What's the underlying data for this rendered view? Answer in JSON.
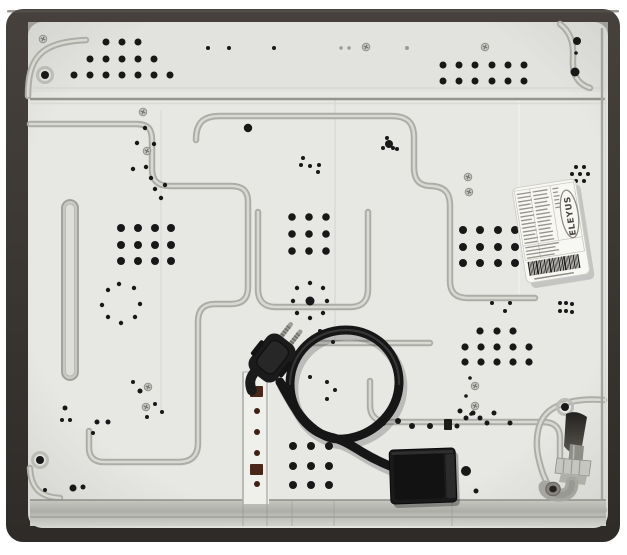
{
  "photo": {
    "subject": "Underside back panel of a built-in gas hob",
    "brand": "ELEYUS"
  },
  "label": {
    "brand": "ELEYUS",
    "bars": [
      [
        -28,
        -42,
        14
      ],
      [
        -12,
        -42,
        15
      ],
      [
        8,
        -42,
        6
      ],
      [
        -28,
        -38.2,
        13
      ],
      [
        -12,
        -38.2,
        14
      ],
      [
        8,
        -38.2,
        5
      ],
      [
        -28,
        -34.4,
        14
      ],
      [
        -12,
        -34.4,
        15
      ],
      [
        8,
        -34.4,
        6
      ],
      [
        -28,
        -30.6,
        12
      ],
      [
        -12,
        -30.6,
        13
      ],
      [
        8,
        -30.6,
        5
      ],
      [
        -28,
        -26.8,
        14
      ],
      [
        -12,
        -26.8,
        15
      ],
      [
        8,
        -26.8,
        6
      ],
      [
        -28,
        -23,
        13
      ],
      [
        -12,
        -23,
        12
      ],
      [
        8,
        -23,
        5
      ],
      [
        -28,
        -19.2,
        14
      ],
      [
        -12,
        -19.2,
        14
      ],
      [
        -28,
        -15.4,
        11
      ],
      [
        -12,
        -15.4,
        15
      ],
      [
        -28,
        -11.6,
        14
      ],
      [
        -12,
        -11.6,
        13
      ],
      [
        -28,
        -7.8,
        13
      ],
      [
        -12,
        -7.8,
        14
      ],
      [
        -28,
        -4,
        14
      ],
      [
        -12,
        -4,
        12
      ],
      [
        -28,
        -0.2,
        12
      ],
      [
        -12,
        -0.2,
        14
      ],
      [
        -28,
        3.6,
        14
      ],
      [
        -12,
        3.6,
        13
      ],
      [
        -28,
        7.4,
        13
      ],
      [
        -12,
        7.4,
        14
      ],
      [
        -28,
        12,
        34
      ],
      [
        -28,
        15.5,
        30
      ],
      [
        -28,
        19,
        33
      ],
      [
        -28,
        22.5,
        28
      ]
    ],
    "barcode": [
      2,
      1,
      1,
      2,
      1,
      3,
      1,
      2,
      1,
      1,
      2,
      1,
      1,
      3,
      1,
      2,
      1,
      1,
      1,
      2,
      1,
      2,
      3,
      1,
      1,
      2,
      1,
      1,
      2,
      1,
      1,
      2
    ]
  },
  "scene": {
    "colors": {
      "hole": "#181818",
      "dimple": "#9a9a96",
      "bracket_hole": "#3c2114"
    },
    "hole_groups": [
      {
        "name": "vents-top-left-pyramid",
        "r": 3.5,
        "points": [
          [
            106,
            42
          ],
          [
            122,
            42
          ],
          [
            138,
            42
          ],
          [
            90,
            59
          ],
          [
            106,
            59
          ],
          [
            122,
            59
          ],
          [
            138,
            59
          ],
          [
            154,
            59
          ],
          [
            74,
            75
          ],
          [
            90,
            75
          ],
          [
            106,
            75
          ],
          [
            122,
            75
          ],
          [
            138,
            75
          ],
          [
            154,
            75
          ],
          [
            170,
            75
          ]
        ]
      },
      {
        "name": "vents-top-small-trio",
        "r": 2,
        "points": [
          [
            208,
            48
          ],
          [
            229,
            48
          ],
          [
            274,
            48
          ]
        ]
      },
      {
        "name": "vents-top-right-grid",
        "r": 3.5,
        "points": [
          [
            443,
            65
          ],
          [
            459,
            65
          ],
          [
            475,
            65
          ],
          [
            492,
            65
          ],
          [
            508,
            65
          ],
          [
            524,
            65
          ],
          [
            443,
            81
          ],
          [
            459,
            81
          ],
          [
            475,
            81
          ],
          [
            492,
            81
          ],
          [
            508,
            81
          ],
          [
            524,
            81
          ]
        ]
      },
      {
        "name": "vents-top-right-corner",
        "points": [
          [
            577,
            41,
            4
          ],
          [
            576,
            53,
            1.8
          ],
          [
            575,
            72,
            4.5
          ]
        ]
      },
      {
        "name": "dimples-top",
        "color": "#9a9a96",
        "points": [
          [
            341,
            48,
            1.7
          ],
          [
            349,
            48,
            1.7
          ],
          [
            407,
            48,
            2
          ]
        ]
      },
      {
        "name": "vents-left-scatter",
        "r": 2.2,
        "points": [
          [
            145,
            128
          ],
          [
            137,
            143
          ],
          [
            154,
            144
          ],
          [
            133,
            169
          ],
          [
            146,
            167
          ],
          [
            151,
            178
          ],
          [
            155,
            189
          ],
          [
            165,
            185
          ],
          [
            161,
            198
          ]
        ]
      },
      {
        "name": "vents-center-left",
        "r": 2,
        "points": [
          [
            303,
            158
          ],
          [
            301,
            165
          ],
          [
            310,
            166
          ],
          [
            319,
            165
          ],
          [
            318,
            172
          ],
          [
            248,
            128,
            4.2
          ]
        ]
      },
      {
        "name": "vents-center-right",
        "r": 2,
        "points": [
          [
            389,
            144,
            4
          ],
          [
            383,
            148
          ],
          [
            393,
            148
          ],
          [
            397,
            149
          ],
          [
            387,
            138
          ]
        ]
      },
      {
        "name": "vents-center-grid-upper",
        "r": 3.8,
        "points": [
          [
            292,
            217
          ],
          [
            309,
            217
          ],
          [
            326,
            217
          ],
          [
            292,
            234
          ],
          [
            309,
            234
          ],
          [
            326,
            234
          ],
          [
            292,
            251
          ],
          [
            309,
            251
          ],
          [
            326,
            251
          ]
        ]
      },
      {
        "name": "vents-right-grid",
        "r": 4,
        "points": [
          [
            463,
            230
          ],
          [
            480,
            230
          ],
          [
            498,
            230
          ],
          [
            515,
            230
          ],
          [
            463,
            247
          ],
          [
            480,
            247
          ],
          [
            498,
            247
          ],
          [
            515,
            247
          ],
          [
            463,
            263
          ],
          [
            480,
            263
          ],
          [
            498,
            263
          ],
          [
            515,
            263
          ]
        ]
      },
      {
        "name": "vents-right-seven",
        "r": 2,
        "points": [
          [
            576,
            167
          ],
          [
            584,
            167
          ],
          [
            572,
            174
          ],
          [
            580,
            174
          ],
          [
            588,
            174
          ],
          [
            576,
            181
          ],
          [
            584,
            181
          ]
        ]
      },
      {
        "name": "vents-left-grid",
        "r": 4,
        "points": [
          [
            121,
            228
          ],
          [
            138,
            228
          ],
          [
            155,
            228
          ],
          [
            171,
            228
          ],
          [
            121,
            245
          ],
          [
            138,
            245
          ],
          [
            155,
            245
          ],
          [
            171,
            245
          ],
          [
            121,
            261
          ],
          [
            138,
            261
          ],
          [
            155,
            261
          ],
          [
            171,
            261
          ]
        ]
      },
      {
        "name": "vents-left-ring",
        "r": 2.2,
        "points": [
          [
            108,
            290
          ],
          [
            119,
            284
          ],
          [
            134,
            288
          ],
          [
            102,
            305
          ],
          [
            140,
            304
          ],
          [
            108,
            317
          ],
          [
            121,
            323
          ],
          [
            135,
            317
          ]
        ]
      },
      {
        "name": "vents-center-ring",
        "r": 2.2,
        "points": [
          [
            310,
            301,
            4.5
          ],
          [
            297,
            288
          ],
          [
            310,
            283
          ],
          [
            323,
            288
          ],
          [
            293,
            301
          ],
          [
            327,
            301
          ],
          [
            297,
            313
          ],
          [
            310,
            318
          ],
          [
            323,
            313
          ]
        ]
      },
      {
        "name": "vents-mid-scatter",
        "r": 2,
        "points": [
          [
            320,
            331
          ],
          [
            333,
            342
          ],
          [
            347,
            331
          ],
          [
            310,
            377
          ],
          [
            327,
            382
          ],
          [
            335,
            390
          ],
          [
            327,
            399
          ],
          [
            253,
            380
          ],
          [
            272,
            379
          ]
        ]
      },
      {
        "name": "vents-right-center-pyramid",
        "r": 3.6,
        "points": [
          [
            480,
            331
          ],
          [
            497,
            331
          ],
          [
            513,
            331
          ],
          [
            465,
            347
          ],
          [
            481,
            347
          ],
          [
            497,
            347
          ],
          [
            513,
            347
          ],
          [
            529,
            347
          ],
          [
            465,
            362
          ],
          [
            481,
            362
          ],
          [
            497,
            362
          ],
          [
            513,
            362
          ],
          [
            529,
            362
          ]
        ]
      },
      {
        "name": "vents-rc-trio",
        "r": 2,
        "points": [
          [
            492,
            303
          ],
          [
            510,
            303
          ],
          [
            505,
            311
          ]
        ]
      },
      {
        "name": "vents-center-grid-lower",
        "r": 4,
        "points": [
          [
            293,
            446
          ],
          [
            311,
            446
          ],
          [
            329,
            446
          ],
          [
            293,
            466
          ],
          [
            311,
            466
          ],
          [
            329,
            466
          ],
          [
            293,
            485
          ],
          [
            311,
            485
          ],
          [
            329,
            485
          ]
        ]
      },
      {
        "name": "vents-bottom-row",
        "r": 3,
        "points": [
          [
            383,
            423
          ],
          [
            398,
            421
          ],
          [
            412,
            426
          ],
          [
            430,
            426
          ],
          [
            457,
            426,
            2.5
          ]
        ]
      },
      {
        "name": "vents-bottom-right-cluster",
        "r": 2.5,
        "points": [
          [
            460,
            411
          ],
          [
            466,
            418
          ],
          [
            473,
            413
          ],
          [
            480,
            418
          ],
          [
            487,
            423
          ],
          [
            494,
            413
          ],
          [
            510,
            423
          ]
        ]
      },
      {
        "name": "vents-right-four",
        "r": 2,
        "points": [
          [
            560,
            303
          ],
          [
            566,
            303
          ],
          [
            572,
            304
          ],
          [
            560,
            311
          ],
          [
            566,
            311
          ],
          [
            572,
            312
          ]
        ]
      },
      {
        "name": "vents-bottom-left-scatter",
        "points": [
          [
            65,
            408,
            2.5
          ],
          [
            62,
            420,
            2
          ],
          [
            70,
            420,
            2
          ],
          [
            97,
            422,
            2.5
          ],
          [
            108,
            422,
            2.5
          ],
          [
            93,
            433,
            2
          ],
          [
            45,
            490,
            2
          ],
          [
            73,
            488,
            3.5
          ],
          [
            83,
            487,
            2.5
          ],
          [
            133,
            382,
            2
          ],
          [
            140,
            391,
            2.5
          ],
          [
            155,
            404,
            2
          ],
          [
            162,
            412,
            2
          ],
          [
            147,
            417,
            2
          ]
        ]
      },
      {
        "name": "vents-junction-right",
        "points": [
          [
            466,
            471,
            5
          ],
          [
            476,
            491,
            2.5
          ]
        ]
      },
      {
        "name": "dots-near-screws",
        "r": 1.8,
        "points": [
          [
            470,
            378
          ],
          [
            466,
            396
          ],
          [
            471,
            414
          ]
        ]
      },
      {
        "name": "bracket-holes",
        "color": "#3c2114",
        "r": 3,
        "points": [
          [
            257,
            411
          ],
          [
            257,
            432
          ],
          [
            257,
            453
          ],
          [
            257,
            484
          ]
        ]
      }
    ],
    "rect_holes": [
      [
        250,
        386,
        13,
        11,
        "#48261a"
      ],
      [
        250,
        464,
        13,
        11,
        "#48261a"
      ],
      [
        444,
        419,
        8,
        11,
        "#1c1c1a"
      ]
    ],
    "ring_holes": [
      [
        45,
        75
      ],
      [
        40,
        460
      ],
      [
        565,
        407
      ]
    ],
    "screws": [
      [
        43,
        39
      ],
      [
        143,
        112
      ],
      [
        147,
        151
      ],
      [
        366,
        47
      ],
      [
        485,
        47
      ],
      [
        148,
        387
      ],
      [
        146,
        407
      ],
      [
        468,
        177
      ],
      [
        469,
        192
      ],
      [
        475,
        386
      ],
      [
        475,
        406
      ]
    ]
  }
}
